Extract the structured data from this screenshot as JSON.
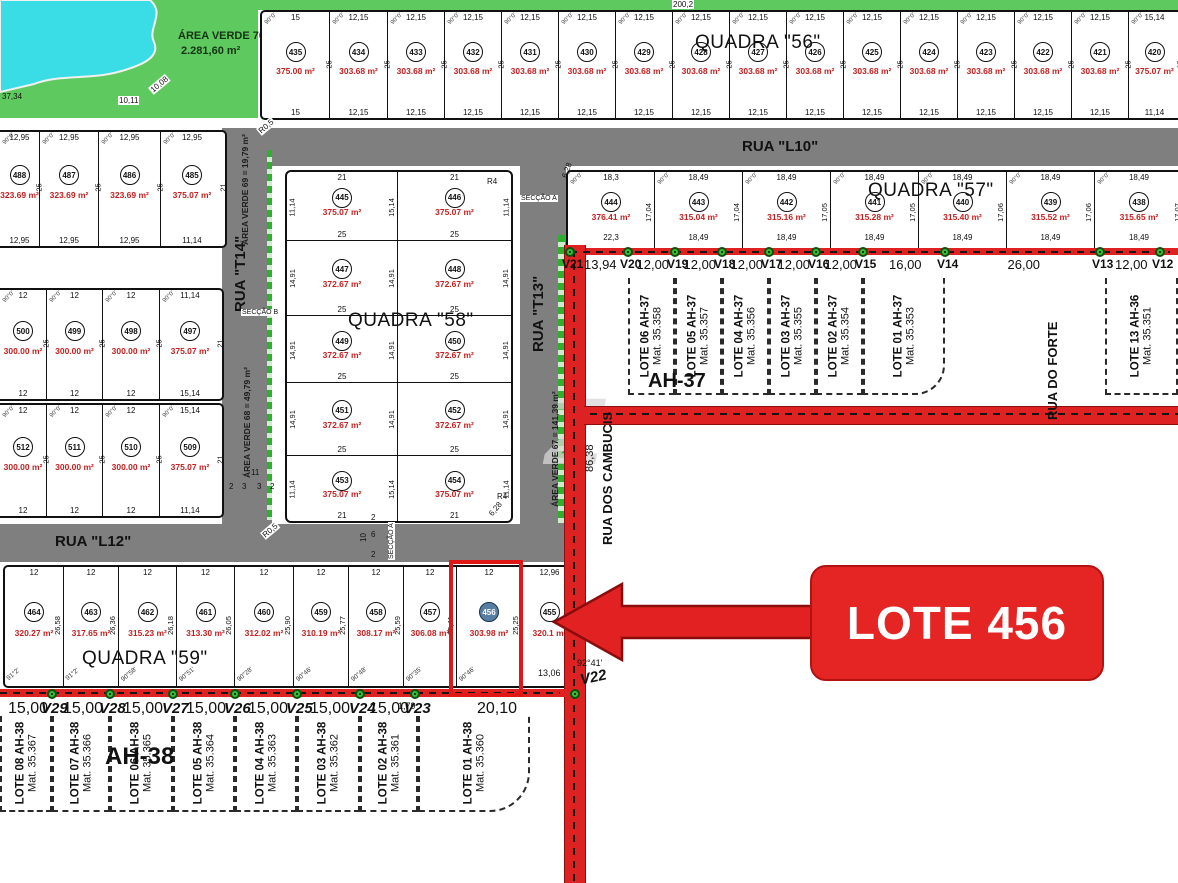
{
  "title_callout": {
    "label": "LOTE 456"
  },
  "quadras": {
    "q56": "QUADRA \"56\"",
    "q57": "QUADRA \"57\"",
    "q58": "QUADRA \"58\"",
    "q59": "QUADRA \"59\""
  },
  "streets": {
    "l10": "RUA \"L10\"",
    "l12": "RUA \"L12\"",
    "t13": "RUA \"T13\"",
    "t14": "RUA \"T14\"",
    "forte": "RUA DO FORTE",
    "cambucis": "RUA DOS CAMBUCIS"
  },
  "green_areas": {
    "v70_title": "ÁREA VERDE 70",
    "v70_area": "2.281,60 m²",
    "v69": "ÁREA VERDE 69 = 19,79 m²",
    "v68": "ÁREA VERDE 68 = 49,79 m²",
    "v67": "ÁREA VERDE 67 = 141,39 m²"
  },
  "sections": {
    "a": "SECÇÃO A",
    "b": "SECÇÃO B"
  },
  "ah_labels": {
    "ah37": "AH-37",
    "ah38": "AH-38"
  },
  "misc": {
    "ang90": "90°0'",
    "watermark": "Z"
  },
  "misc_labels": [
    "200,2",
    "37,34",
    "10,11",
    "10,08",
    "R0,5",
    "R0,5",
    "R4",
    "6,28",
    "R4",
    "6,28",
    "13,06",
    "92°41'",
    "1,79",
    "10",
    "2",
    "6",
    "2",
    "11",
    "2",
    "3",
    "3",
    "2",
    "86,38"
  ],
  "boundary": {
    "top_v": [
      "V21",
      "V20",
      "V19",
      "V18",
      "V17",
      "V16",
      "V15",
      "V14",
      "V13",
      "V12"
    ],
    "top_d": [
      "13,94",
      "12,00",
      "12,00",
      "12,00",
      "12,00",
      "12,00",
      "16,00",
      "26,00",
      "12,00"
    ],
    "bot_v": [
      "V29",
      "V28",
      "V27",
      "V26",
      "V25",
      "V24",
      "V23",
      "V22"
    ],
    "bot_d": [
      "15,00",
      "15,00",
      "15,00",
      "15,00",
      "15,00",
      "15,00",
      "15,00",
      "20,10"
    ]
  },
  "blocks": {
    "q56": {
      "lots": [
        {
          "n": "435",
          "a": "375.00 m²",
          "wt": "15",
          "wb": "15",
          "s": "25",
          "px": 68
        },
        {
          "n": "434",
          "a": "303.68 m²",
          "wt": "12,15",
          "wb": "12,15",
          "s": "25",
          "px": 58
        },
        {
          "n": "433",
          "a": "303.68 m²",
          "wt": "12,15",
          "wb": "12,15",
          "s": "25",
          "px": 57
        },
        {
          "n": "432",
          "a": "303.68 m²",
          "wt": "12,15",
          "wb": "12,15",
          "s": "25",
          "px": 57
        },
        {
          "n": "431",
          "a": "303.68 m²",
          "wt": "12,15",
          "wb": "12,15",
          "s": "25",
          "px": 57
        },
        {
          "n": "430",
          "a": "303.68 m²",
          "wt": "12,15",
          "wb": "12,15",
          "s": "25",
          "px": 57
        },
        {
          "n": "429",
          "a": "303.68 m²",
          "wt": "12,15",
          "wb": "12,15",
          "s": "25",
          "px": 57
        },
        {
          "n": "428",
          "a": "303.68 m²",
          "wt": "12,15",
          "wb": "12,15",
          "s": "25",
          "px": 57
        },
        {
          "n": "427",
          "a": "303.68 m²",
          "wt": "12,15",
          "wb": "12,15",
          "s": "25",
          "px": 57
        },
        {
          "n": "426",
          "a": "303.68 m²",
          "wt": "12,15",
          "wb": "12,15",
          "s": "25",
          "px": 57
        },
        {
          "n": "425",
          "a": "303.68 m²",
          "wt": "12,15",
          "wb": "12,15",
          "s": "25",
          "px": 57
        },
        {
          "n": "424",
          "a": "303.68 m²",
          "wt": "12,15",
          "wb": "12,15",
          "s": "25",
          "px": 57
        },
        {
          "n": "423",
          "a": "303.68 m²",
          "wt": "12,15",
          "wb": "12,15",
          "s": "25",
          "px": 57
        },
        {
          "n": "422",
          "a": "303.68 m²",
          "wt": "12,15",
          "wb": "12,15",
          "s": "25",
          "px": 57
        },
        {
          "n": "421",
          "a": "303.68 m²",
          "wt": "12,15",
          "wb": "12,15",
          "s": "25",
          "px": 57
        },
        {
          "n": "420",
          "a": "375.07 m²",
          "wt": "15,14",
          "wb": "11,14",
          "s": "25",
          "px": 51
        }
      ]
    },
    "q57": {
      "lots": [
        {
          "n": "444",
          "a": "376.41 m²",
          "wt": "18,3",
          "wb": "22,3",
          "s": "17,04",
          "px": 87
        },
        {
          "n": "443",
          "a": "315.04 m²",
          "wt": "18,49",
          "wb": "18,49",
          "s": "17,04",
          "px": 88
        },
        {
          "n": "442",
          "a": "315.16 m²",
          "wt": "18,49",
          "wb": "18,49",
          "s": "17,05",
          "px": 88
        },
        {
          "n": "441",
          "a": "315.28 m²",
          "wt": "18,49",
          "wb": "18,49",
          "s": "17,05",
          "px": 88
        },
        {
          "n": "440",
          "a": "315.40 m²",
          "wt": "18,49",
          "wb": "18,49",
          "s": "17,06",
          "px": 88
        },
        {
          "n": "439",
          "a": "315.52 m²",
          "wt": "18,49",
          "wb": "18,49",
          "s": "17,06",
          "px": 88
        },
        {
          "n": "438",
          "a": "315.65 m²",
          "wt": "18,49",
          "wb": "18,49",
          "s": "17,07",
          "px": 88
        }
      ]
    },
    "left1": {
      "lots": [
        {
          "n": "488",
          "a": "323.69 m²",
          "wt": "12,95",
          "wb": "12,95",
          "s": "25",
          "px": 40
        },
        {
          "n": "487",
          "a": "323.69 m²",
          "wt": "12,95",
          "wb": "12,95",
          "s": "25",
          "px": 59
        },
        {
          "n": "486",
          "a": "323.69 m²",
          "wt": "12,95",
          "wb": "12,95",
          "s": "25",
          "px": 62
        },
        {
          "n": "485",
          "a": "375.07 m²",
          "wt": "12,95",
          "wb": "11,14",
          "s": "21",
          "px": 62
        }
      ]
    },
    "left2": {
      "lots": [
        {
          "n": "500",
          "a": "300.00 m²",
          "wt": "12",
          "wb": "12",
          "s": "25",
          "px": 47
        },
        {
          "n": "499",
          "a": "300.00 m²",
          "wt": "12",
          "wb": "12",
          "s": "25",
          "px": 56
        },
        {
          "n": "498",
          "a": "300.00 m²",
          "wt": "12",
          "wb": "12",
          "s": "25",
          "px": 57
        },
        {
          "n": "497",
          "a": "375.07 m²",
          "wt": "11,14",
          "wb": "15,14",
          "s": "21",
          "px": 60
        }
      ]
    },
    "left3": {
      "lots": [
        {
          "n": "512",
          "a": "300.00 m²",
          "wt": "12",
          "wb": "12",
          "s": "25",
          "px": 47
        },
        {
          "n": "511",
          "a": "300.00 m²",
          "wt": "12",
          "wb": "12",
          "s": "25",
          "px": 56
        },
        {
          "n": "510",
          "a": "300.00 m²",
          "wt": "12",
          "wb": "12",
          "s": "25",
          "px": 57
        },
        {
          "n": "509",
          "a": "375.07 m²",
          "wt": "15,14",
          "wb": "11,14",
          "s": "21",
          "px": 60
        }
      ]
    },
    "q58": {
      "rows": [
        [
          {
            "n": "445",
            "a": "375.07 m²",
            "wt": "21",
            "wb": "25",
            "sl": "11,14",
            "s": "15,14"
          },
          {
            "n": "446",
            "a": "375.07 m²",
            "wt": "21",
            "wb": "25",
            "s": "11,14"
          }
        ],
        [
          {
            "n": "447",
            "a": "372.67 m²",
            "wb": "25",
            "sl": "14,91",
            "s": "14,91"
          },
          {
            "n": "448",
            "a": "372.67 m²",
            "wb": "25",
            "s": "14,91"
          }
        ],
        [
          {
            "n": "449",
            "a": "372.67 m²",
            "wb": "25",
            "sl": "14,91",
            "s": "14,91"
          },
          {
            "n": "450",
            "a": "372.67 m²",
            "wb": "25",
            "s": "14,91"
          }
        ],
        [
          {
            "n": "451",
            "a": "372.67 m²",
            "wb": "25",
            "sl": "14,91",
            "s": "14,91"
          },
          {
            "n": "452",
            "a": "372.67 m²",
            "wb": "25",
            "s": "14,91"
          }
        ],
        [
          {
            "n": "453",
            "a": "375.07 m²",
            "wb": "21",
            "sl": "11,14",
            "s": "15,14"
          },
          {
            "n": "454",
            "a": "375.07 m²",
            "wb": "21",
            "s": "11,14"
          }
        ]
      ]
    },
    "q59": {
      "lots": [
        {
          "n": "464",
          "a": "320.27 m²",
          "wt": "12",
          "s": "26,58",
          "ang": "91°2'",
          "px": 59
        },
        {
          "n": "463",
          "a": "317.65 m²",
          "wt": "12",
          "s": "26,36",
          "ang": "91°2'",
          "px": 55
        },
        {
          "n": "462",
          "a": "315.23 m²",
          "wt": "12",
          "s": "26,18",
          "ang": "90°58'",
          "px": 58
        },
        {
          "n": "461",
          "a": "313.30 m²",
          "wt": "12",
          "s": "26,05",
          "ang": "90°51'",
          "px": 58
        },
        {
          "n": "460",
          "a": "312.02 m²",
          "wt": "12",
          "s": "25,90",
          "ang": "90°28'",
          "px": 59
        },
        {
          "n": "459",
          "a": "310.19 m²",
          "wt": "12",
          "s": "25,77",
          "ang": "90°46'",
          "px": 55
        },
        {
          "n": "458",
          "a": "308.17 m²",
          "wt": "12",
          "s": "25,59",
          "ang": "90°48'",
          "px": 55
        },
        {
          "n": "457",
          "a": "306.08 m²",
          "wt": "12",
          "s": "25,41",
          "ang": "90°35'",
          "px": 53
        },
        {
          "n": "456",
          "a": "303.98 m²",
          "wt": "12",
          "s": "25,25",
          "ang": "90°46'",
          "px": 65,
          "hl": true
        },
        {
          "n": "455",
          "a": "320.1 m²",
          "wt": "12,96",
          "px": 55
        }
      ]
    }
  },
  "ah37": {
    "lots": [
      {
        "t": "LOTE 06 AH-37",
        "m": "Mat. 35.358"
      },
      {
        "t": "LOTE 05 AH-37",
        "m": "Mat. 35.357"
      },
      {
        "t": "LOTE 04 AH-37",
        "m": "Mat. 35.356"
      },
      {
        "t": "LOTE 03 AH-37",
        "m": "Mat. 35.355"
      },
      {
        "t": "LOTE 02 AH-37",
        "m": "Mat. 35.354"
      },
      {
        "t": "LOTE 01 AH-37",
        "m": "Mat. 35.353"
      }
    ]
  },
  "ah36_lot": {
    "t": "LOTE 13 AH-36",
    "m": "Mat. 35.351"
  },
  "ah38": {
    "lots": [
      {
        "t": "LOTE 08 AH-38",
        "m": "Mat. 35.367"
      },
      {
        "t": "LOTE 07 AH-38",
        "m": "Mat. 35.366"
      },
      {
        "t": "LOTE 06 AH-38",
        "m": "Mat. 35.365"
      },
      {
        "t": "LOTE 05 AH-38",
        "m": "Mat. 35.364"
      },
      {
        "t": "LOTE 04 AH-38",
        "m": "Mat. 35.363"
      },
      {
        "t": "LOTE 03 AH-38",
        "m": "Mat. 35.362"
      },
      {
        "t": "LOTE 02 AH-38",
        "m": "Mat. 35.361"
      },
      {
        "t": "LOTE 01 AH-38",
        "m": "Mat. 35.360"
      }
    ]
  }
}
